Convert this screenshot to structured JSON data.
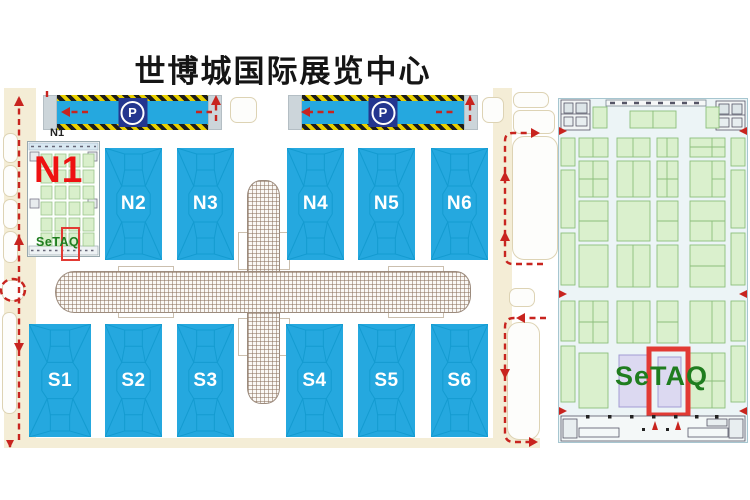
{
  "title": "世博城国际展览中心",
  "overview_map": {
    "hall_n1_small_label": "N1",
    "hall_n1_big_label": "N1",
    "exhibitor": "SeTAQ",
    "parking_symbol": "P",
    "north_halls": [
      "N2",
      "N3",
      "N4",
      "N5",
      "N6"
    ],
    "south_halls": [
      "S1",
      "S2",
      "S3",
      "S4",
      "S5",
      "S6"
    ]
  },
  "detail_panel": {
    "title": "N1",
    "exhibitor": "SeTAQ"
  },
  "colors": {
    "hall_fill": "#25a8df",
    "hall_line": "#149bd0",
    "hall_label": "#ffffff",
    "road": "#f4edd6",
    "route_red": "#c8241f",
    "n1_text_red": "#ee1111",
    "setaq_green": "#1f7d1f",
    "highlight_red": "#e23a34",
    "parking_badge_navy": "#24368f",
    "booth_green": "#daf0cd",
    "booth_green_border": "#8cbe7c",
    "booth_purple": "#dcd9f1",
    "booth_purple_border": "#a29bd4",
    "panel_bg": "#ecf4f6",
    "corridor_line": "#9c8b7d"
  }
}
